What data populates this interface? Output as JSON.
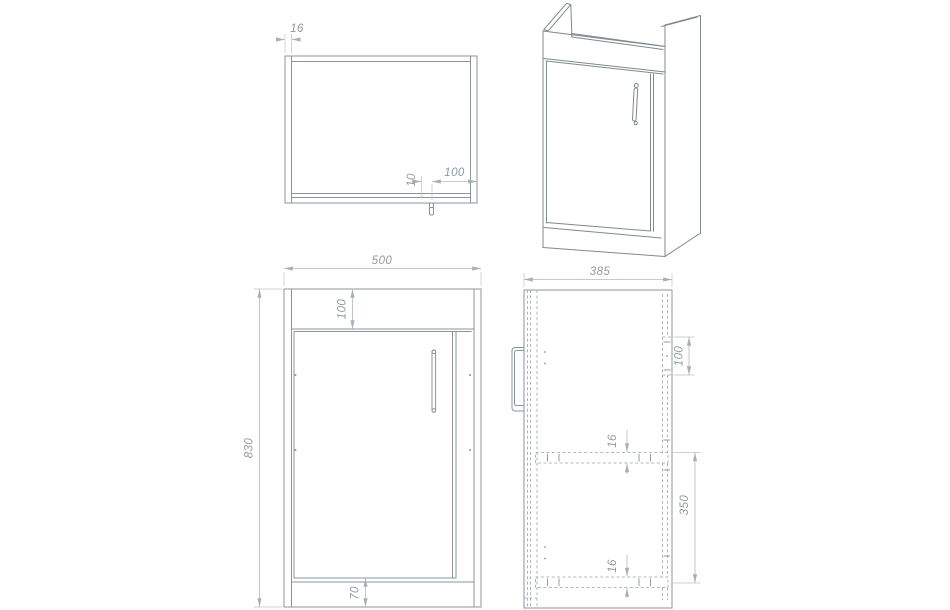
{
  "drawing": {
    "type": "furniture technical drawing — vanity basin unit, four views",
    "background": "#ffffff",
    "object_line_color": "#8a949b",
    "hidden_line_color": "#9aa3a9",
    "dimension_line_color": "#b2b8bc",
    "dimension_text_color": "#929aa0"
  },
  "views": {
    "plan": {
      "name": "plan view (top)",
      "dims": {
        "side_panel_thickness": "16",
        "handle_gap": "10",
        "handle_inset": "100"
      }
    },
    "iso": {
      "name": "isometric view"
    },
    "front": {
      "name": "front view",
      "dims": {
        "width": "500",
        "top_rail_height": "100",
        "height": "830",
        "plinth_height": "70"
      }
    },
    "side": {
      "name": "side view",
      "dims": {
        "depth": "385",
        "back_rail_height": "100",
        "shelf_thickness_top": "16",
        "shelf_spacing": "350",
        "shelf_thickness_bottom": "16"
      }
    }
  }
}
